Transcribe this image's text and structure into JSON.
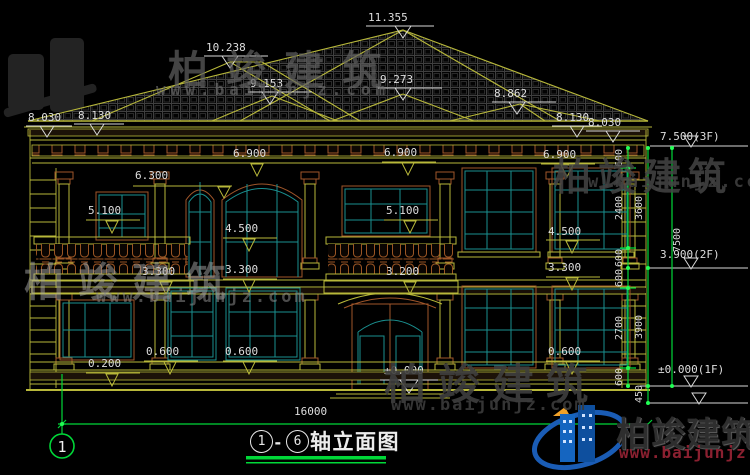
{
  "watermarks": {
    "brand": "柏竣建筑",
    "url": "www.baijunjz.com",
    "url_short": "w.baijunjz.com"
  },
  "logo": {
    "brand": "柏竣建筑",
    "url": "www.baijunjz.com"
  },
  "titlebar": {
    "axis_start": "1",
    "dash": "-",
    "axis_end": "6",
    "label": "轴立面图"
  },
  "axis_bubble": "1",
  "dims": {
    "total_width": "16000",
    "ridge": "11.355",
    "roof_left": "10.238",
    "roof_left2": "9.153",
    "roof_center": "9.273",
    "roof_right": "8.862",
    "eave_left_outer": "8.030",
    "eave_left_inner": "8.130",
    "eave_right_inner": "8.130",
    "eave_right_outer": "8.030",
    "level_3f": "7.500(3F)",
    "ceiling_left": "6.900",
    "ceiling_center": "6.900",
    "ceiling_right": "6.900",
    "window_head_left": "6.300",
    "rail_left": "5.100",
    "rail_center": "5.100",
    "sill2_left": "4.500",
    "sill2_right": "4.500",
    "level_2f": "3.900(2F)",
    "floor2_left": "3.300",
    "floor2_mid": "3.300",
    "floor2_right": "3.300",
    "entry_arch": "3.200",
    "sill1_left": "0.600",
    "sill1_mid": "0.600",
    "sill1_right": "0.600",
    "plinth": "0.200",
    "ground_center": "±0.000",
    "level_1f": "±0.000(1F)"
  },
  "vdims": {
    "seg600_a": "600",
    "seg2400": "2400",
    "seg600_b": "600",
    "seg600_c": "600",
    "seg2700": "2700",
    "seg600_d": "600",
    "seg3600": "3600",
    "seg3900": "3900",
    "seg450": "450",
    "seg7500": "7500"
  },
  "colors": {
    "line_olive": "#b8b83a",
    "line_green": "#00d838",
    "line_teal": "#1a8f8f",
    "line_brown": "#a0562a",
    "text": "#dedede",
    "logo_blue": "#1a5cb5",
    "logo_url_red": "#8a2030"
  }
}
